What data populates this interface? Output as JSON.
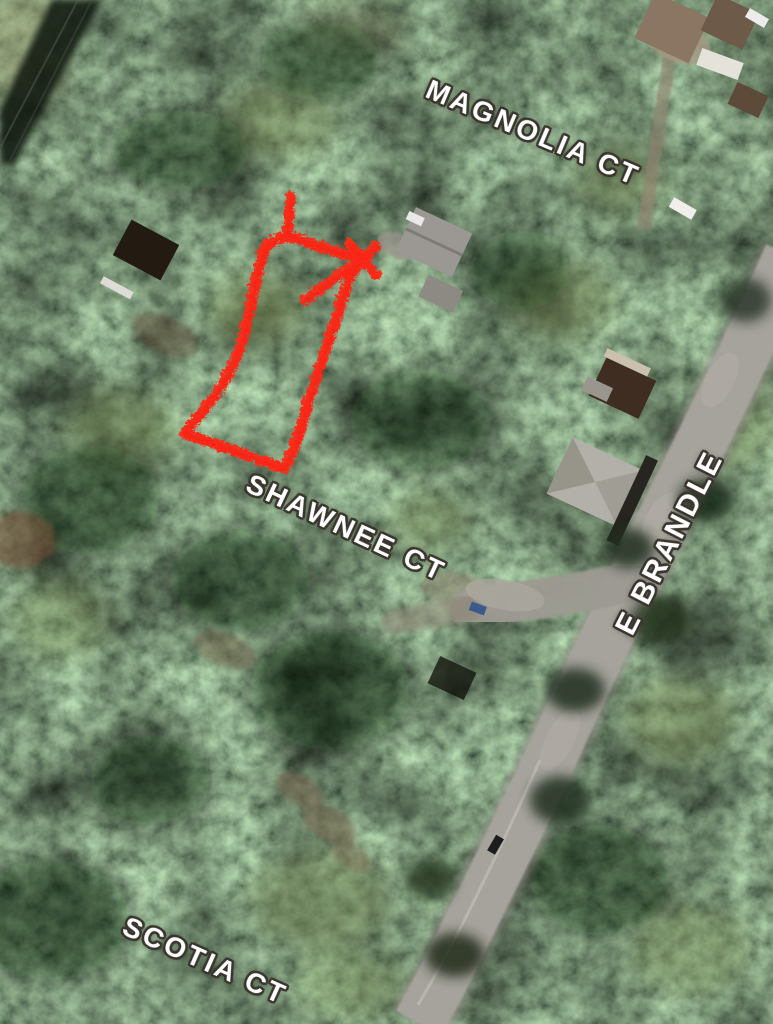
{
  "map": {
    "view_type": "satellite-aerial",
    "street_labels": [
      {
        "id": "magnolia-ct",
        "name": "MAGNOLIA CT"
      },
      {
        "id": "shawnee-ct",
        "name": "SHAWNEE CT"
      },
      {
        "id": "e-brandle",
        "name": "E BRANDLE"
      },
      {
        "id": "scotia-ct",
        "name": "SCOTIA CT"
      }
    ],
    "annotations": {
      "parcel_outline": {
        "shape": "hand-drawn-rectangle",
        "color": "#f5301c"
      }
    },
    "colors": {
      "label_text": "#ffffff",
      "label_halo": "#3a362e",
      "road_gray": "#a6a39c",
      "forest_dark": "#101808",
      "forest_light": "#71824e"
    }
  }
}
